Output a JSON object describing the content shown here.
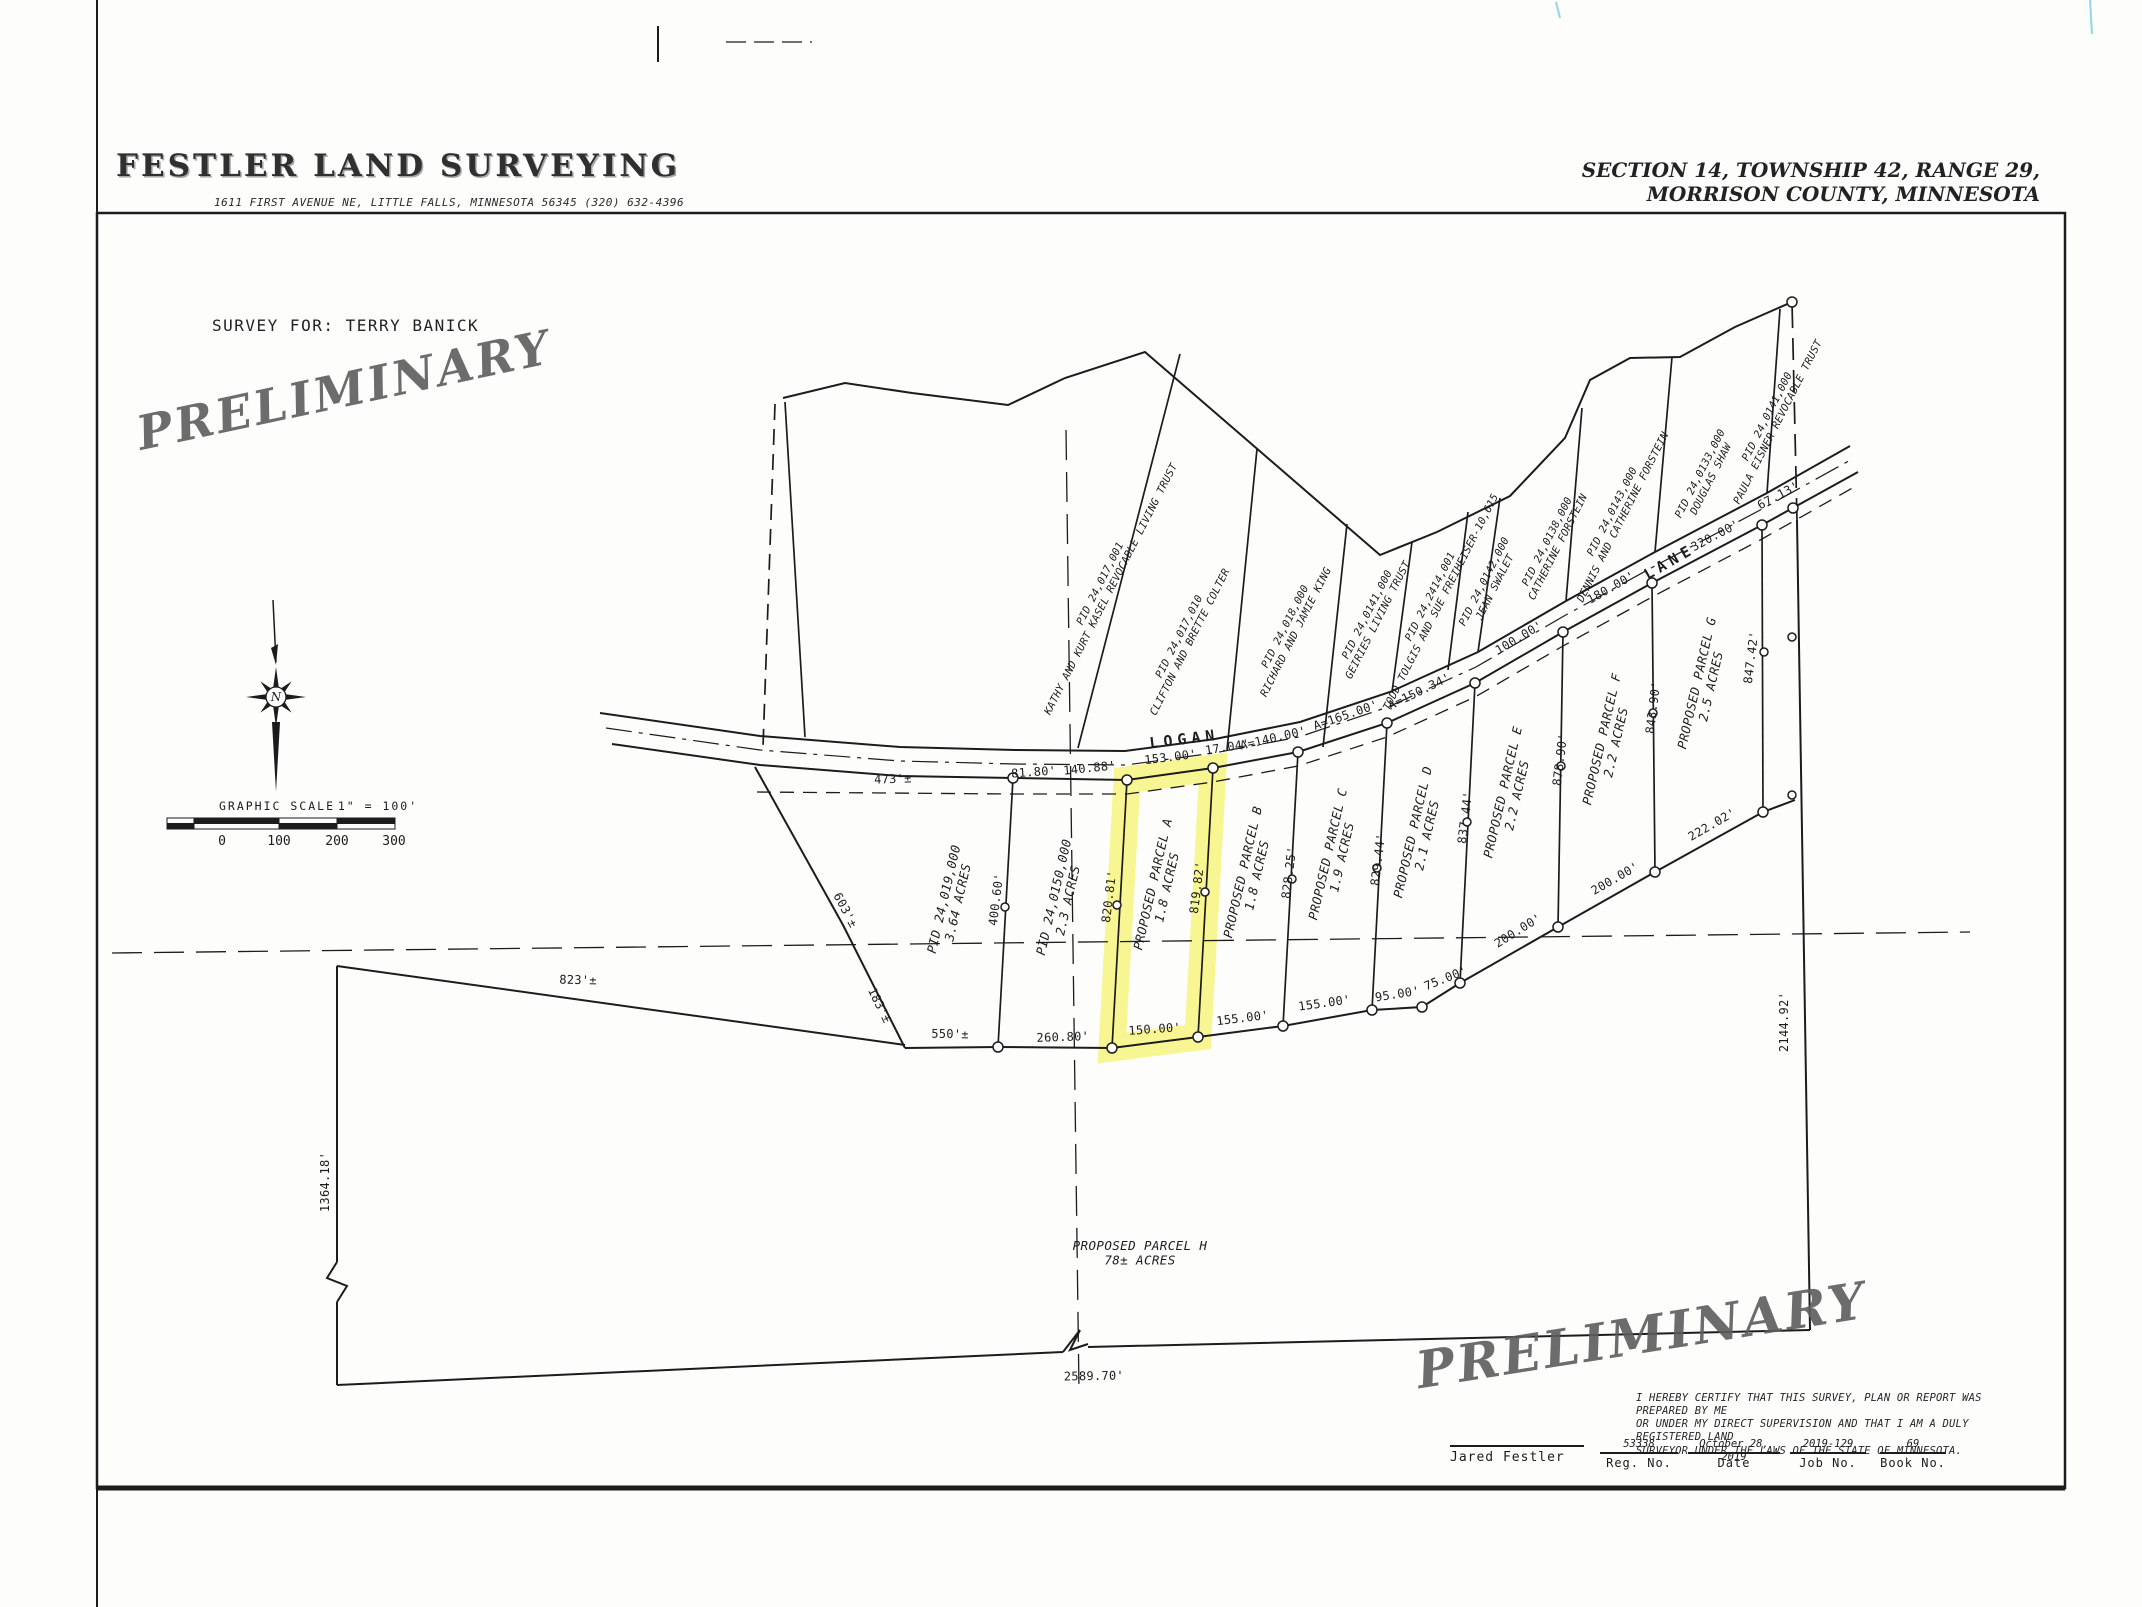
{
  "colors": {
    "ink": "#1c1c1c",
    "highlight_yellow": "#f5f250",
    "watermark_gray": "#5d5d5d",
    "scan_mark_cyan": "#8fd8e4"
  },
  "sheet": {
    "company": "FESTLER LAND SURVEYING",
    "company_address": "1611 FIRST AVENUE NE, LITTLE FALLS, MINNESOTA 56345  (320) 632-4396",
    "location_line1": "SECTION 14, TOWNSHIP 42, RANGE 29,",
    "location_line2": "MORRISON COUNTY, MINNESOTA",
    "survey_for": "SURVEY FOR:  TERRY BANICK",
    "watermark": "PRELIMINARY"
  },
  "compass": {
    "north_label": "N"
  },
  "scale_bar": {
    "title": "GRAPHIC SCALE",
    "ratio": "1\" = 100'",
    "ticks": {
      "t0": "0",
      "t1": "100",
      "t2": "200",
      "t3": "300"
    }
  },
  "certification": {
    "line1": "I HEREBY CERTIFY THAT THIS SURVEY, PLAN OR REPORT WAS PREPARED BY ME",
    "line2": "OR UNDER MY DIRECT SUPERVISION AND THAT I AM A DULY REGISTERED LAND",
    "line3": "SURVEYOR UNDER THE LAWS OF THE STATE OF MINNESOTA.",
    "surveyor_name": "Jared Festler",
    "reg_no": "53338",
    "reg_label": "Reg. No.",
    "date": "October 28, 2019",
    "date_label": "Date",
    "job_no": "2019-129",
    "job_label": "Job No.",
    "book_no": "69",
    "book_label": "Book No."
  },
  "plat": {
    "road_name": "LOGAN LANE",
    "highlighted_parcel": "PROPOSED PARCEL A",
    "labels": [
      {
        "t": "LOGAN",
        "x": 1185,
        "y": 744,
        "r": -7,
        "c": "road"
      },
      {
        "t": "LANE",
        "x": 1672,
        "y": 566,
        "r": -30,
        "c": "road"
      },
      {
        "t": "473'±",
        "x": 893,
        "y": 783,
        "r": -2,
        "c": "dim"
      },
      {
        "t": "81.80'",
        "x": 1034,
        "y": 776,
        "r": -4,
        "c": "dim"
      },
      {
        "t": "140.88'",
        "x": 1090,
        "y": 772,
        "r": -6,
        "c": "dim"
      },
      {
        "t": "153.00'",
        "x": 1171,
        "y": 761,
        "r": -7,
        "c": "dim"
      },
      {
        "t": "17.04'",
        "x": 1228,
        "y": 751,
        "r": -9,
        "c": "dim"
      },
      {
        "t": "A=140.00'",
        "x": 1274,
        "y": 742,
        "r": -13,
        "c": "dim"
      },
      {
        "t": "A=165.00'",
        "x": 1347,
        "y": 719,
        "r": -19,
        "c": "dim"
      },
      {
        "t": "A=150.34'",
        "x": 1421,
        "y": 695,
        "r": -26,
        "c": "dim"
      },
      {
        "t": "100.00'",
        "x": 1521,
        "y": 641,
        "r": -31,
        "c": "dim"
      },
      {
        "t": "180.00'",
        "x": 1613,
        "y": 591,
        "r": -30,
        "c": "dim"
      },
      {
        "t": "320.00'",
        "x": 1717,
        "y": 539,
        "r": -28,
        "c": "dim"
      },
      {
        "t": "67.13'",
        "x": 1780,
        "y": 499,
        "r": -28,
        "c": "dim"
      },
      {
        "t": "400.60'",
        "x": 1000,
        "y": 900,
        "r": -83,
        "c": "dim"
      },
      {
        "t": "820.81'",
        "x": 1113,
        "y": 897,
        "r": -83,
        "c": "dim"
      },
      {
        "t": "819.82'",
        "x": 1201,
        "y": 888,
        "r": -83,
        "c": "dim"
      },
      {
        "t": "828.25'",
        "x": 1293,
        "y": 873,
        "r": -83,
        "c": "dim"
      },
      {
        "t": "829.44'",
        "x": 1382,
        "y": 860,
        "r": -83,
        "c": "dim"
      },
      {
        "t": "837.44'",
        "x": 1469,
        "y": 818,
        "r": -83,
        "c": "dim"
      },
      {
        "t": "878.90'",
        "x": 1564,
        "y": 760,
        "r": -83,
        "c": "dim"
      },
      {
        "t": "843.90'",
        "x": 1657,
        "y": 708,
        "r": -83,
        "c": "dim"
      },
      {
        "t": "847.42'",
        "x": 1755,
        "y": 658,
        "r": -83,
        "c": "dim"
      },
      {
        "t": "550'±",
        "x": 950,
        "y": 1038,
        "r": 1,
        "c": "dim"
      },
      {
        "t": "260.80'",
        "x": 1063,
        "y": 1041,
        "r": -2,
        "c": "dim"
      },
      {
        "t": "150.00'",
        "x": 1155,
        "y": 1033,
        "r": -4,
        "c": "dim"
      },
      {
        "t": "155.00'",
        "x": 1243,
        "y": 1022,
        "r": -7,
        "c": "dim"
      },
      {
        "t": "155.00'",
        "x": 1325,
        "y": 1007,
        "r": -8,
        "c": "dim"
      },
      {
        "t": "95.00'",
        "x": 1398,
        "y": 998,
        "r": -9,
        "c": "dim"
      },
      {
        "t": "75.00'",
        "x": 1447,
        "y": 982,
        "r": -22,
        "c": "dim"
      },
      {
        "t": "200.00'",
        "x": 1520,
        "y": 934,
        "r": -32,
        "c": "dim"
      },
      {
        "t": "200.00'",
        "x": 1617,
        "y": 882,
        "r": -30,
        "c": "dim"
      },
      {
        "t": "222.02'",
        "x": 1714,
        "y": 828,
        "r": -30,
        "c": "dim"
      },
      {
        "t": "603'±",
        "x": 842,
        "y": 912,
        "r": 62,
        "c": "dim"
      },
      {
        "t": "183'±",
        "x": 876,
        "y": 1007,
        "r": 64,
        "c": "dim"
      },
      {
        "t": "823'±",
        "x": 578,
        "y": 984,
        "r": 1,
        "c": "dim"
      },
      {
        "t": "1364.18'",
        "x": 329,
        "y": 1182,
        "r": -90,
        "c": "dim"
      },
      {
        "t": "2589.70'",
        "x": 1094,
        "y": 1380,
        "r": -1,
        "c": "dim"
      },
      {
        "t": "2144.92'",
        "x": 1788,
        "y": 1022,
        "r": -90,
        "c": "dim"
      },
      {
        "t": "PID 24,019,000\n3.64 ACRES",
        "x": 948,
        "y": 900,
        "r": -77,
        "c": "parcel"
      },
      {
        "t": "PID 24,0150,000\n2.3 ACRES",
        "x": 1058,
        "y": 898,
        "r": -77,
        "c": "parcel"
      },
      {
        "t": "PROPOSED PARCEL A\n1.8 ACRES",
        "x": 1157,
        "y": 885,
        "r": -77,
        "c": "parcel"
      },
      {
        "t": "PROPOSED PARCEL B\n1.8 ACRES",
        "x": 1247,
        "y": 873,
        "r": -77,
        "c": "parcel"
      },
      {
        "t": "PROPOSED PARCEL C\n1.9 ACRES",
        "x": 1332,
        "y": 855,
        "r": -77,
        "c": "parcel"
      },
      {
        "t": "PROPOSED PARCEL D\n2.1 ACRES",
        "x": 1417,
        "y": 833,
        "r": -77,
        "c": "parcel"
      },
      {
        "t": "PROPOSED PARCEL E\n2.2 ACRES",
        "x": 1507,
        "y": 793,
        "r": -77,
        "c": "parcel"
      },
      {
        "t": "PROPOSED PARCEL F\n2.2 ACRES",
        "x": 1606,
        "y": 740,
        "r": -77,
        "c": "parcel"
      },
      {
        "t": "PROPOSED PARCEL G\n2.5 ACRES",
        "x": 1701,
        "y": 684,
        "r": -77,
        "c": "parcel"
      },
      {
        "t": "PROPOSED PARCEL H\n78± ACRES",
        "x": 1140,
        "y": 1250,
        "r": 0,
        "c": "parcel"
      },
      {
        "t": "PID 24,017,001\nKATHY AND KURT KASEL REVOCABLE LIVING TRUST",
        "x": 1103,
        "y": 585,
        "r": -63,
        "c": "owner"
      },
      {
        "t": "PID 24,017,010\nCLIFTON AND BRETTE COLTER",
        "x": 1182,
        "y": 638,
        "r": -63,
        "c": "owner"
      },
      {
        "t": "PID 24,018,000\nRICHARD AND JAMIE KING",
        "x": 1288,
        "y": 628,
        "r": -63,
        "c": "owner"
      },
      {
        "t": "PID 24,0141,000\nGEIRIES LIVING TRUST",
        "x": 1370,
        "y": 616,
        "r": -63,
        "c": "owner"
      },
      {
        "t": "PID 24,2414,001\nTODD TOLGIS AND SUE FREIHEISER-10,615",
        "x": 1433,
        "y": 598,
        "r": -63,
        "c": "owner"
      },
      {
        "t": "PID 24,0142,000\nJEAN SWALET",
        "x": 1487,
        "y": 583,
        "r": -63,
        "c": "owner"
      },
      {
        "t": "PID 24,0138,000\nCATHERINE FORSTEIN",
        "x": 1550,
        "y": 543,
        "r": -63,
        "c": "owner"
      },
      {
        "t": "PID 24,0143,000\nDENNIS AND CATHERINE FORSTEIN",
        "x": 1615,
        "y": 513,
        "r": -63,
        "c": "owner"
      },
      {
        "t": "PID 24,0133,000\nDOUGLAS SHAW",
        "x": 1703,
        "y": 475,
        "r": -63,
        "c": "owner"
      },
      {
        "t": "PID 24,0141,000\nPAULA EISNER REVOCABLE TRUST",
        "x": 1770,
        "y": 418,
        "r": -63,
        "c": "owner"
      }
    ]
  }
}
